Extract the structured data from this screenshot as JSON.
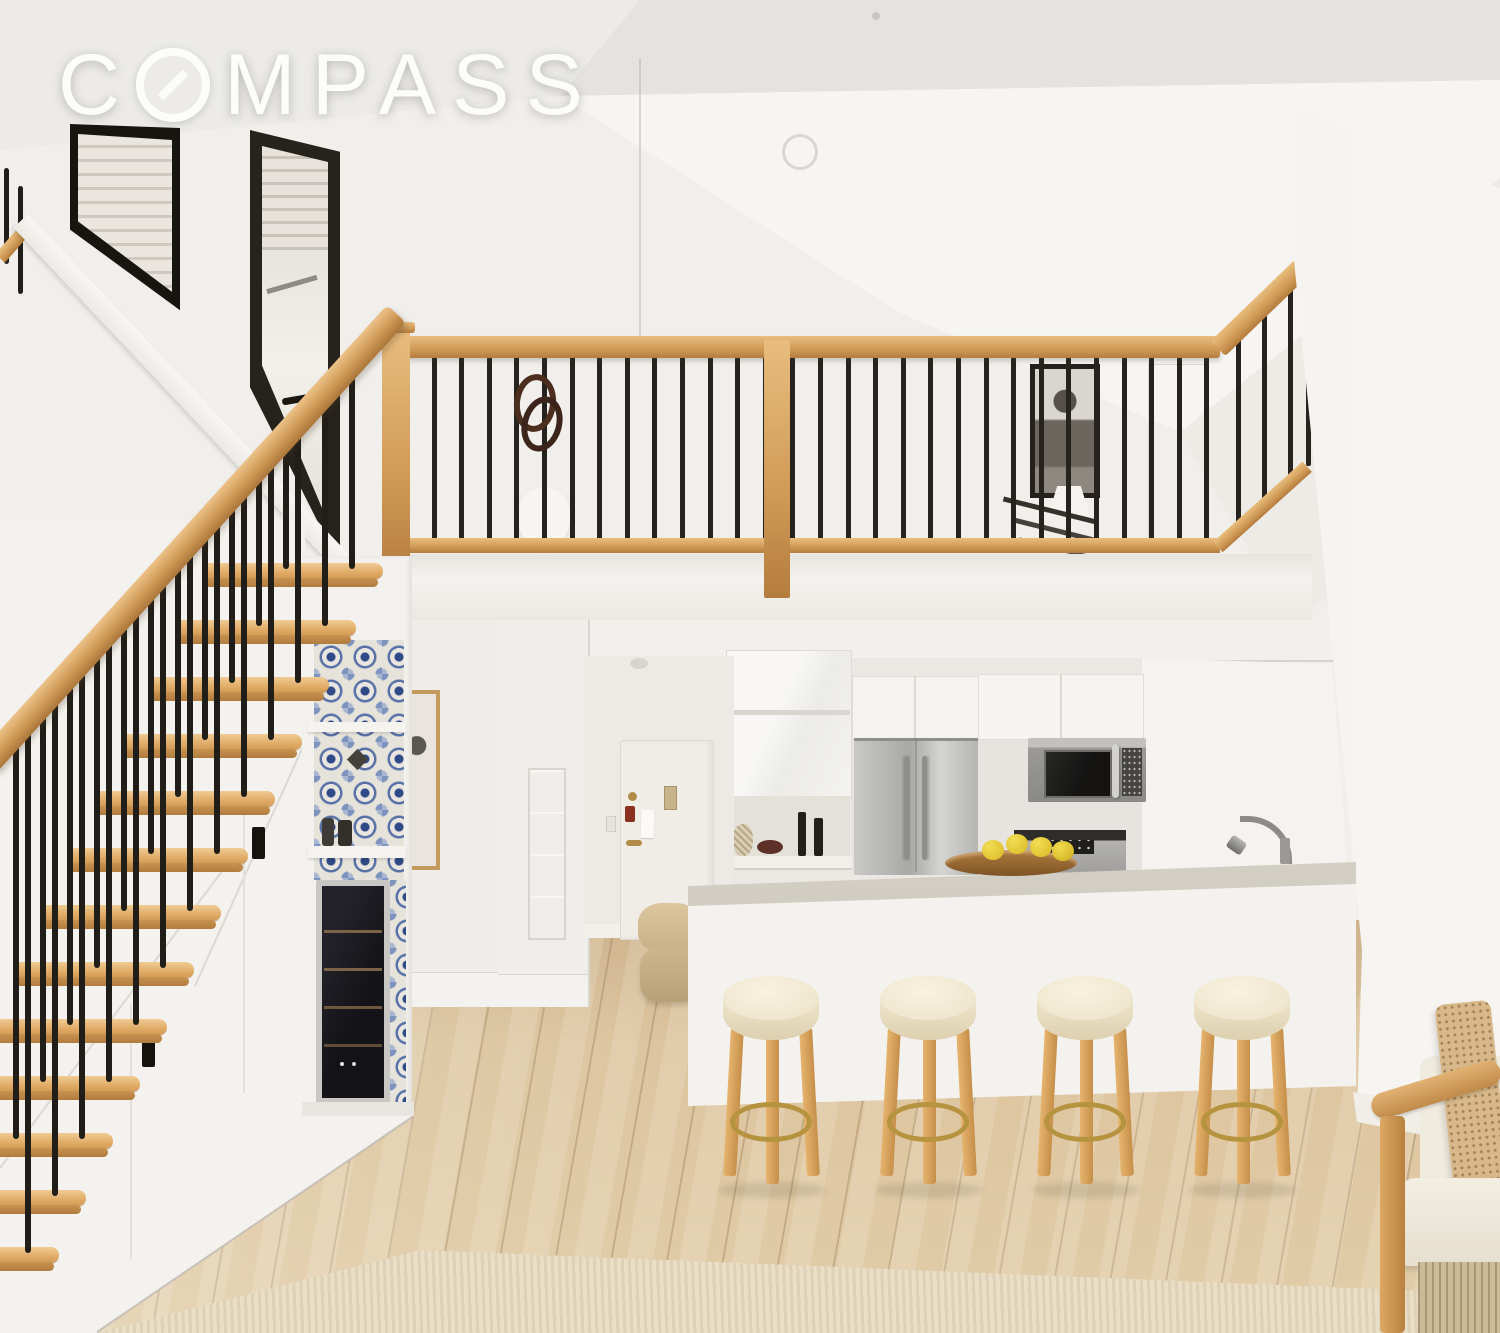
{
  "watermark": {
    "brand": "COMPASS",
    "brand_prefix": "C",
    "brand_suffix": "MPASS"
  },
  "palette": {
    "wall_white": "#f1efec",
    "wall_bright": "#f6f5f3",
    "wall_shadow": "#e5e3e0",
    "ceiling_plane": "#ecebe7",
    "wood_rail": "#cf9a55",
    "wood_tread": "#e3b274",
    "wood_dark": "#b07c3e",
    "metal_black": "#211d18",
    "floor_wood": "#d9c09b",
    "rug": "#e9dec6",
    "tile_blue": "#2f4a86",
    "tile_soft": "#7e93bd",
    "stainless": "#b8b7b5",
    "appliance_dark": "#2b2a28",
    "counter_gray": "#d5d0c6",
    "island_white": "#f4f2ee",
    "cushion_cream": "#f2e9d3",
    "brass": "#b6933f",
    "lemon": "#e8c832",
    "bowl_wood": "#96652f",
    "pillow_tan": "#d8b88a",
    "door_white": "#f0ede7",
    "lock_red": "#8b3122",
    "hardware_brass": "#b08c48"
  },
  "scene": {
    "stairs": {
      "visible_steps": 13
    },
    "mezzanine": {
      "baluster_count": 30
    },
    "stools": {
      "count": 4
    },
    "objects": [
      "staircase",
      "stair-handrail",
      "under-stair-cabinets",
      "wine-cooler",
      "mosaic-tile-niche",
      "mezzanine-railing",
      "newel-post",
      "portrait-artwork",
      "table-lamp",
      "hanging-rings",
      "kitchen",
      "refrigerator",
      "microwave-oven",
      "range",
      "kitchen-island",
      "island-countertop",
      "faucet",
      "fruit-bowl",
      "lemons",
      "bar-stools",
      "entry-door",
      "wall-mirror",
      "framed-art",
      "ottoman",
      "wood-floor",
      "area-rug",
      "armchair",
      "throw-pillow",
      "window",
      "terrace-door",
      "compass-watermark"
    ]
  }
}
